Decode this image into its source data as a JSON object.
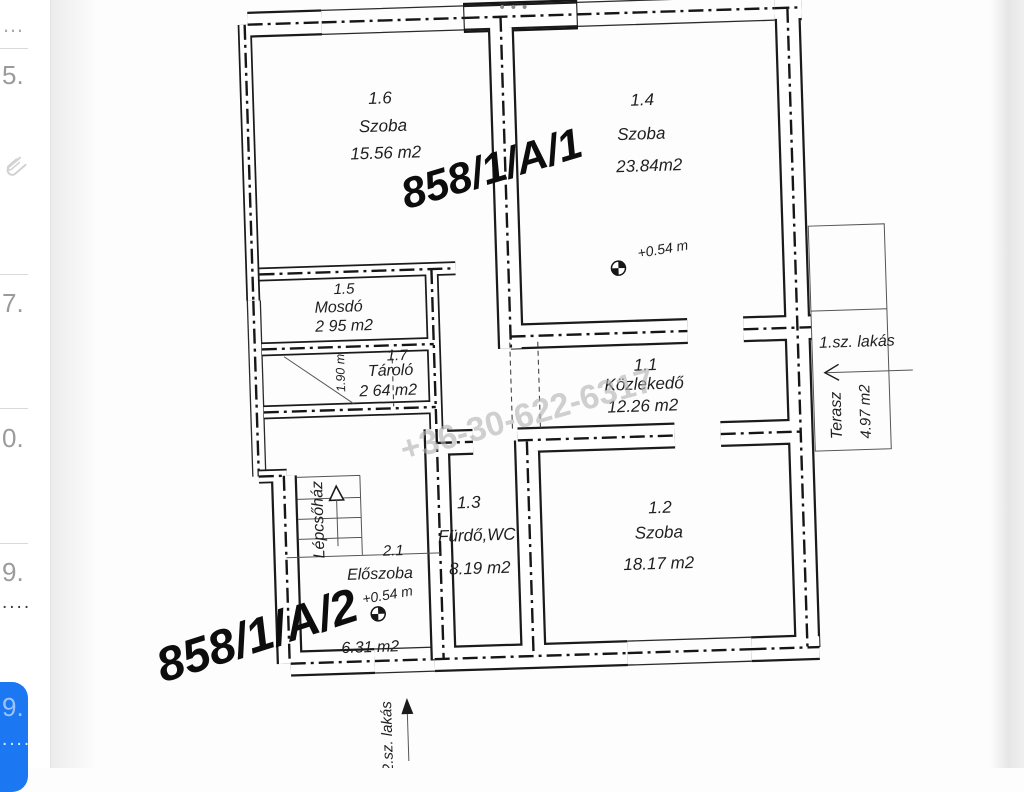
{
  "app": {
    "menu_dots": "•••"
  },
  "sidebar": {
    "rows": [
      {
        "label": "…"
      },
      {
        "label": "5.",
        "icon": "paperclip"
      },
      {
        "label": "7."
      },
      {
        "label": "0."
      },
      {
        "label": "9.",
        "sub": "...."
      },
      {
        "label": "9.",
        "sub": "....",
        "selected": true
      }
    ]
  },
  "floorplan": {
    "parcel_labels": {
      "unit1": "858/1/A/1",
      "unit2": "858/1/A/2"
    },
    "watermark": "+36-30-622-6317",
    "rooms": [
      {
        "num": "1.6",
        "name": "Szoba",
        "area": "15.56 m2"
      },
      {
        "num": "1.4",
        "name": "Szoba",
        "area": "23.84m2",
        "elevation": "+0.54 m"
      },
      {
        "num": "1.5",
        "name": "Mosdó",
        "area": "2 95 m2"
      },
      {
        "num": "1.7",
        "name": "Tároló",
        "area": "2 64 m2",
        "width_dim": "1.90 m"
      },
      {
        "num": "1.1",
        "name": "Közlekedő",
        "area": "12.26 m2"
      },
      {
        "num": "1.3",
        "name": "Fürdő,WC",
        "area": "8.19 m2"
      },
      {
        "num": "1.2",
        "name": "Szoba",
        "area": "18.17 m2"
      },
      {
        "num": "2.1",
        "name": "Előszoba",
        "area": "6.31 m2",
        "elevation": "+0.54 m"
      }
    ],
    "stairwell_label": "Lépcsőház",
    "terrace": {
      "name": "Terasz",
      "area": "4.97 m2"
    },
    "flat1_label": "1.sz. lakás",
    "flat2_label": "2.sz. lakás"
  }
}
